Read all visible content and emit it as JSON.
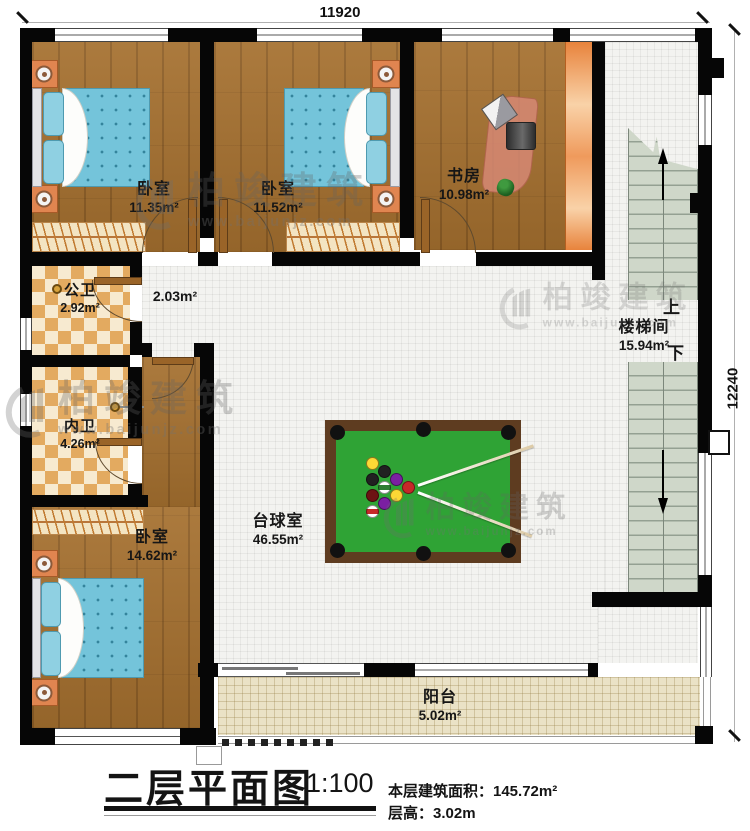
{
  "dimensions": {
    "top": "11920",
    "right": "12240"
  },
  "rooms": {
    "bedroom1": {
      "name": "卧室",
      "area": "11.35m²"
    },
    "bedroom2": {
      "name": "卧室",
      "area": "11.52m²"
    },
    "study": {
      "name": "书房",
      "area": "10.98m²"
    },
    "public_bath": {
      "name": "公卫",
      "area": "2.92m²"
    },
    "hall": {
      "area": "2.03m²"
    },
    "inner_bath": {
      "name": "内卫",
      "area": "4.26m²"
    },
    "bedroom3": {
      "name": "卧室",
      "area": "14.62m²"
    },
    "billiard_room": {
      "name": "台球室",
      "area": "46.55m²"
    },
    "stairwell": {
      "name": "楼梯间",
      "area": "15.94m²",
      "up_label": "上",
      "down_label": "下"
    },
    "balcony": {
      "name": "阳台",
      "area": "5.02m²"
    }
  },
  "title_block": {
    "title": "二层平面图",
    "scale": "1:100",
    "floor_area": "本层建筑面积：145.72m²",
    "floor_height": "层高：3.02m"
  },
  "watermark": {
    "name": "柏竣建筑",
    "url": "www.baijunjz.com"
  },
  "colors": {
    "wall": "#060606",
    "wood_floor": "#a5702f",
    "bath_tile": "#e3aa60",
    "hall_tile": "#f3f3f0",
    "balcony_tile": "#eae2c6",
    "stair_tread": "#cfd7c9",
    "billiard_felt": "#2fa335",
    "billiard_frame": "#5e3c20",
    "mattress_blue": "#74c4da",
    "cabinet_orange": "#ef9a5c"
  }
}
